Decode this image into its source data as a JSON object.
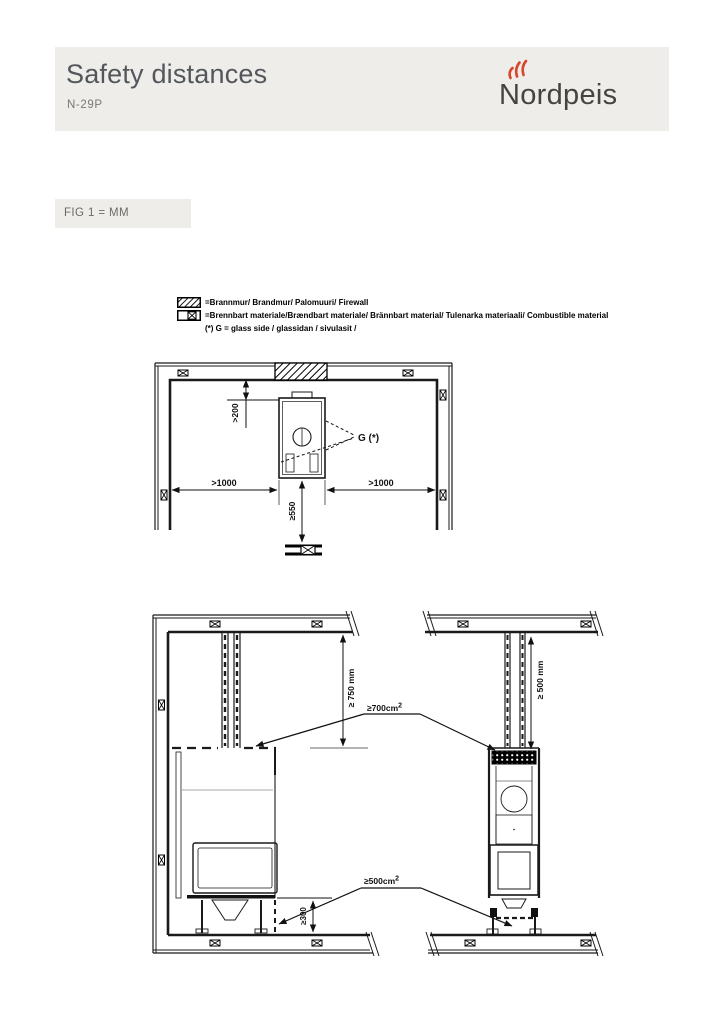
{
  "header": {
    "title": "Safety distances",
    "model": "N-29P",
    "brand": "Nordpeis"
  },
  "figure_label": "FIG 1 = MM",
  "legend": {
    "firewall_label": "=Brannmur/ Brandmur/ Palomuuri/ Firewall",
    "combustible_label": "=Brennbart materiale/Brændbart materiale/ Brännbart material/ Tulenarka materiaali/ Combustible material",
    "glass_note": "(*) G = glass side / glassidan / sivulasit /"
  },
  "top_view": {
    "rear_clearance": ">200",
    "left_clearance": ">1000",
    "right_clearance": ">1000",
    "front_clearance": "≥550",
    "glass_marker": "G (*)"
  },
  "side_views": {
    "ceiling_clearance_left": "≥ 750 mm",
    "ceiling_clearance_right": "≥ 500 mm",
    "top_vent_value": "≥700cm",
    "top_vent_sup": "2",
    "bottom_vent_value": "≥500cm",
    "bottom_vent_sup": "2",
    "floor_clearance": "≥300"
  },
  "colors": {
    "flame_accent": "#d8472b",
    "header_background": "#efedea",
    "line_ink": "#1a1a1a"
  }
}
